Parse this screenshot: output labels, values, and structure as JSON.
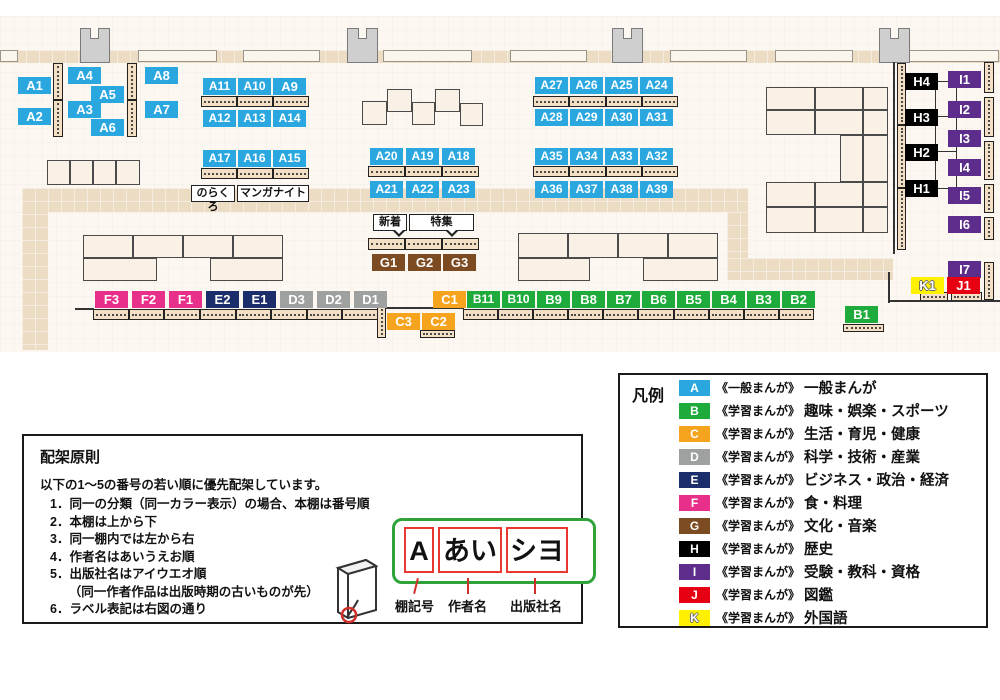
{
  "palette": {
    "A": "#2BA7E0",
    "B": "#1FAA3C",
    "C": "#F6A41D",
    "D": "#9FA0A0",
    "E": "#1C2D6C",
    "F": "#E8308A",
    "G": "#7C4B22",
    "H": "#000000",
    "I": "#5C2D8B",
    "J": "#E60012",
    "K": "#FFF100"
  },
  "map": {
    "wall_segments": [
      {
        "x": 0,
        "w": 18
      },
      {
        "x": 138,
        "w": 79
      },
      {
        "x": 243,
        "w": 77
      },
      {
        "x": 383,
        "w": 89
      },
      {
        "x": 510,
        "w": 77
      },
      {
        "x": 670,
        "w": 77
      },
      {
        "x": 775,
        "w": 78
      },
      {
        "x": 903,
        "w": 96
      }
    ],
    "pillars": [
      {
        "x": 80,
        "y": 28,
        "w": 30,
        "h": 35
      },
      {
        "x": 347,
        "y": 28,
        "w": 31,
        "h": 35
      },
      {
        "x": 612,
        "y": 28,
        "w": 31,
        "h": 35
      },
      {
        "x": 879,
        "y": 28,
        "w": 31,
        "h": 35
      }
    ],
    "paths": [
      {
        "x": 0,
        "y": 50,
        "w": 1000,
        "h": 13
      },
      {
        "x": 22,
        "y": 188,
        "w": 726,
        "h": 24
      },
      {
        "x": 22,
        "y": 188,
        "w": 26,
        "h": 162
      },
      {
        "x": 727,
        "y": 212,
        "w": 21,
        "h": 46
      },
      {
        "x": 727,
        "y": 258,
        "w": 166,
        "h": 22
      }
    ],
    "tables": [
      {
        "x": 47,
        "y": 160,
        "w": 23,
        "h": 25
      },
      {
        "x": 70,
        "y": 160,
        "w": 23,
        "h": 25
      },
      {
        "x": 93,
        "y": 160,
        "w": 23,
        "h": 25
      },
      {
        "x": 116,
        "y": 160,
        "w": 24,
        "h": 25
      },
      {
        "x": 387,
        "y": 89,
        "w": 25,
        "h": 23
      },
      {
        "x": 435,
        "y": 89,
        "w": 25,
        "h": 23
      },
      {
        "x": 362,
        "y": 101,
        "w": 25,
        "h": 24
      },
      {
        "x": 412,
        "y": 102,
        "w": 23,
        "h": 23
      },
      {
        "x": 460,
        "y": 103,
        "w": 23,
        "h": 23
      },
      {
        "x": 83,
        "y": 235,
        "w": 50,
        "h": 23
      },
      {
        "x": 133,
        "y": 235,
        "w": 50,
        "h": 23
      },
      {
        "x": 183,
        "y": 235,
        "w": 50,
        "h": 23
      },
      {
        "x": 233,
        "y": 235,
        "w": 50,
        "h": 23
      },
      {
        "x": 83,
        "y": 258,
        "w": 74,
        "h": 23
      },
      {
        "x": 210,
        "y": 258,
        "w": 73,
        "h": 23
      },
      {
        "x": 518,
        "y": 233,
        "w": 50,
        "h": 25
      },
      {
        "x": 568,
        "y": 233,
        "w": 50,
        "h": 25
      },
      {
        "x": 618,
        "y": 233,
        "w": 50,
        "h": 25
      },
      {
        "x": 668,
        "y": 233,
        "w": 50,
        "h": 25
      },
      {
        "x": 518,
        "y": 258,
        "w": 72,
        "h": 23
      },
      {
        "x": 643,
        "y": 258,
        "w": 75,
        "h": 23
      },
      {
        "x": 766,
        "y": 87,
        "w": 49,
        "h": 23
      },
      {
        "x": 815,
        "y": 87,
        "w": 48,
        "h": 23
      },
      {
        "x": 863,
        "y": 87,
        "w": 25,
        "h": 23
      },
      {
        "x": 766,
        "y": 110,
        "w": 49,
        "h": 25
      },
      {
        "x": 815,
        "y": 110,
        "w": 48,
        "h": 25
      },
      {
        "x": 863,
        "y": 110,
        "w": 25,
        "h": 25
      },
      {
        "x": 840,
        "y": 135,
        "w": 23,
        "h": 47
      },
      {
        "x": 863,
        "y": 135,
        "w": 25,
        "h": 47
      },
      {
        "x": 766,
        "y": 182,
        "w": 49,
        "h": 25
      },
      {
        "x": 815,
        "y": 182,
        "w": 48,
        "h": 25
      },
      {
        "x": 863,
        "y": 182,
        "w": 25,
        "h": 25
      },
      {
        "x": 766,
        "y": 207,
        "w": 49,
        "h": 26
      },
      {
        "x": 815,
        "y": 207,
        "w": 48,
        "h": 26
      },
      {
        "x": 863,
        "y": 207,
        "w": 25,
        "h": 26
      }
    ],
    "shelves_h": [
      {
        "x": 201,
        "y": 96,
        "w": 108,
        "h": 11,
        "n": 3
      },
      {
        "x": 201,
        "y": 168,
        "w": 108,
        "h": 11,
        "n": 3
      },
      {
        "x": 368,
        "y": 166,
        "w": 111,
        "h": 11,
        "n": 3
      },
      {
        "x": 533,
        "y": 96,
        "w": 145,
        "h": 11,
        "n": 4
      },
      {
        "x": 533,
        "y": 166,
        "w": 145,
        "h": 11,
        "n": 4
      },
      {
        "x": 368,
        "y": 238,
        "w": 111,
        "h": 12,
        "n": 3
      },
      {
        "x": 93,
        "y": 309,
        "w": 285,
        "h": 11,
        "n": 8
      },
      {
        "x": 463,
        "y": 309,
        "w": 351,
        "h": 11,
        "n": 10
      },
      {
        "x": 420,
        "y": 330,
        "w": 35,
        "h": 8,
        "n": 1
      },
      {
        "x": 843,
        "y": 324,
        "w": 41,
        "h": 8,
        "n": 1
      },
      {
        "x": 920,
        "y": 292,
        "w": 28,
        "h": 9,
        "n": 1
      },
      {
        "x": 951,
        "y": 292,
        "w": 31,
        "h": 9,
        "n": 1
      }
    ],
    "shelves_v": [
      {
        "x": 53,
        "y": 63,
        "w": 10,
        "h": 74,
        "n": 2
      },
      {
        "x": 127,
        "y": 63,
        "w": 10,
        "h": 74,
        "n": 2
      },
      {
        "x": 377,
        "y": 306,
        "w": 9,
        "h": 32,
        "n": 1
      },
      {
        "x": 897,
        "y": 63,
        "w": 9,
        "h": 187,
        "n": 3
      },
      {
        "x": 984,
        "y": 62,
        "w": 10,
        "h": 31,
        "n": 1
      },
      {
        "x": 984,
        "y": 97,
        "w": 10,
        "h": 40,
        "n": 1
      },
      {
        "x": 984,
        "y": 141,
        "w": 10,
        "h": 39,
        "n": 1
      },
      {
        "x": 984,
        "y": 184,
        "w": 10,
        "h": 29,
        "n": 1
      },
      {
        "x": 984,
        "y": 217,
        "w": 10,
        "h": 23,
        "n": 1
      },
      {
        "x": 984,
        "y": 262,
        "w": 10,
        "h": 38,
        "n": 1
      }
    ],
    "lines": [
      {
        "x": 893,
        "y": 62,
        "w": 2,
        "h": 192
      },
      {
        "x": 888,
        "y": 272,
        "w": 2,
        "h": 31
      },
      {
        "x": 889,
        "y": 300,
        "w": 111,
        "h": 2
      },
      {
        "x": 75,
        "y": 308,
        "w": 19,
        "h": 2
      },
      {
        "x": 386,
        "y": 307,
        "w": 78,
        "h": 2
      },
      {
        "x": 935,
        "y": 81,
        "w": 1,
        "h": 108
      },
      {
        "x": 956,
        "y": 81,
        "w": 1,
        "h": 108
      },
      {
        "x": 936,
        "y": 81,
        "w": 21,
        "h": 1
      },
      {
        "x": 936,
        "y": 116,
        "w": 21,
        "h": 1
      },
      {
        "x": 936,
        "y": 151,
        "w": 21,
        "h": 1
      },
      {
        "x": 936,
        "y": 188,
        "w": 21,
        "h": 1
      }
    ],
    "labels": [
      {
        "t": "A1",
        "x": 18,
        "y": 77
      },
      {
        "t": "A2",
        "x": 18,
        "y": 108
      },
      {
        "t": "A4",
        "x": 68,
        "y": 67
      },
      {
        "t": "A5",
        "x": 91,
        "y": 86
      },
      {
        "t": "A3",
        "x": 68,
        "y": 101
      },
      {
        "t": "A6",
        "x": 91,
        "y": 119
      },
      {
        "t": "A8",
        "x": 145,
        "y": 67
      },
      {
        "t": "A7",
        "x": 145,
        "y": 101
      },
      {
        "t": "A11",
        "x": 203,
        "y": 78
      },
      {
        "t": "A10",
        "x": 238,
        "y": 78
      },
      {
        "t": "A9",
        "x": 273,
        "y": 78
      },
      {
        "t": "A12",
        "x": 203,
        "y": 110
      },
      {
        "t": "A13",
        "x": 238,
        "y": 110
      },
      {
        "t": "A14",
        "x": 273,
        "y": 110
      },
      {
        "t": "A17",
        "x": 203,
        "y": 150
      },
      {
        "t": "A16",
        "x": 238,
        "y": 150
      },
      {
        "t": "A15",
        "x": 273,
        "y": 150
      },
      {
        "t": "A20",
        "x": 370,
        "y": 148
      },
      {
        "t": "A19",
        "x": 406,
        "y": 148
      },
      {
        "t": "A18",
        "x": 442,
        "y": 148
      },
      {
        "t": "A21",
        "x": 370,
        "y": 181
      },
      {
        "t": "A22",
        "x": 406,
        "y": 181
      },
      {
        "t": "A23",
        "x": 442,
        "y": 181
      },
      {
        "t": "A27",
        "x": 535,
        "y": 77
      },
      {
        "t": "A26",
        "x": 570,
        "y": 77
      },
      {
        "t": "A25",
        "x": 605,
        "y": 77
      },
      {
        "t": "A24",
        "x": 640,
        "y": 77
      },
      {
        "t": "A28",
        "x": 535,
        "y": 109
      },
      {
        "t": "A29",
        "x": 570,
        "y": 109
      },
      {
        "t": "A30",
        "x": 605,
        "y": 109
      },
      {
        "t": "A31",
        "x": 640,
        "y": 109
      },
      {
        "t": "A35",
        "x": 535,
        "y": 148
      },
      {
        "t": "A34",
        "x": 570,
        "y": 148
      },
      {
        "t": "A33",
        "x": 605,
        "y": 148
      },
      {
        "t": "A32",
        "x": 640,
        "y": 148
      },
      {
        "t": "A36",
        "x": 535,
        "y": 181
      },
      {
        "t": "A37",
        "x": 570,
        "y": 181
      },
      {
        "t": "A38",
        "x": 605,
        "y": 181
      },
      {
        "t": "A39",
        "x": 640,
        "y": 181
      },
      {
        "t": "G1",
        "x": 372,
        "y": 254
      },
      {
        "t": "G2",
        "x": 408,
        "y": 254
      },
      {
        "t": "G3",
        "x": 443,
        "y": 254
      },
      {
        "t": "F3",
        "x": 95,
        "y": 291
      },
      {
        "t": "F2",
        "x": 132,
        "y": 291
      },
      {
        "t": "F1",
        "x": 169,
        "y": 291
      },
      {
        "t": "E2",
        "x": 206,
        "y": 291
      },
      {
        "t": "E1",
        "x": 243,
        "y": 291
      },
      {
        "t": "D3",
        "x": 280,
        "y": 291
      },
      {
        "t": "D2",
        "x": 317,
        "y": 291
      },
      {
        "t": "D1",
        "x": 354,
        "y": 291
      },
      {
        "t": "C1",
        "x": 433,
        "y": 291
      },
      {
        "t": "B11",
        "x": 467,
        "y": 291
      },
      {
        "t": "B10",
        "x": 502,
        "y": 291
      },
      {
        "t": "B9",
        "x": 537,
        "y": 291
      },
      {
        "t": "B8",
        "x": 572,
        "y": 291
      },
      {
        "t": "B7",
        "x": 607,
        "y": 291
      },
      {
        "t": "B6",
        "x": 642,
        "y": 291
      },
      {
        "t": "B5",
        "x": 677,
        "y": 291
      },
      {
        "t": "B4",
        "x": 712,
        "y": 291
      },
      {
        "t": "B3",
        "x": 747,
        "y": 291
      },
      {
        "t": "B2",
        "x": 782,
        "y": 291
      },
      {
        "t": "C3",
        "x": 387,
        "y": 313
      },
      {
        "t": "C2",
        "x": 422,
        "y": 313
      },
      {
        "t": "B1",
        "x": 845,
        "y": 306
      },
      {
        "t": "H4",
        "x": 905,
        "y": 73
      },
      {
        "t": "H3",
        "x": 905,
        "y": 109
      },
      {
        "t": "H2",
        "x": 905,
        "y": 144
      },
      {
        "t": "H1",
        "x": 905,
        "y": 180
      },
      {
        "t": "I1",
        "x": 948,
        "y": 71
      },
      {
        "t": "I2",
        "x": 948,
        "y": 101
      },
      {
        "t": "I3",
        "x": 948,
        "y": 130
      },
      {
        "t": "I4",
        "x": 948,
        "y": 159
      },
      {
        "t": "I5",
        "x": 948,
        "y": 187
      },
      {
        "t": "I6",
        "x": 948,
        "y": 216
      },
      {
        "t": "I7",
        "x": 948,
        "y": 261
      },
      {
        "t": "K1",
        "x": 911,
        "y": 277
      },
      {
        "t": "J1",
        "x": 947,
        "y": 277
      }
    ],
    "tags": [
      {
        "t": "のらくろ",
        "x": 191,
        "y": 185,
        "w": 44,
        "bubble": false
      },
      {
        "t": "マンガナイト",
        "x": 237,
        "y": 185,
        "w": 72,
        "bubble": false
      },
      {
        "t": "新着",
        "x": 373,
        "y": 214,
        "w": 34,
        "bubble": true
      },
      {
        "t": "特集",
        "x": 409,
        "y": 214,
        "w": 65,
        "bubble": true
      }
    ]
  },
  "principles": {
    "title": "配架原則",
    "intro": "以下の1～5の番号の若い順に優先配架しています。",
    "items": [
      "1．同一の分類（同一カラー表示）の場合、本棚は番号順",
      "2．本棚は上から下",
      "3．同一棚内では左から右",
      "4．作者名はあいうえお順",
      "5．出版社名はアイウエオ順",
      "　　（同一作者作品は出版時期の古いものが先）",
      "6．ラベル表記は右図の通り"
    ]
  },
  "diagram": {
    "plate_fields": [
      {
        "value": "A",
        "caption": "棚記号"
      },
      {
        "value": "あい",
        "caption": "作者名"
      },
      {
        "value": "シヨ",
        "caption": "出版社名"
      }
    ]
  },
  "legend": {
    "title": "凡例",
    "rows": [
      {
        "key": "A",
        "tag": "《一般まんが》",
        "label": "一般まんが"
      },
      {
        "key": "B",
        "tag": "《学習まんが》",
        "label": "趣味・娯楽・スポーツ"
      },
      {
        "key": "C",
        "tag": "《学習まんが》",
        "label": "生活・育児・健康"
      },
      {
        "key": "D",
        "tag": "《学習まんが》",
        "label": "科学・技術・産業"
      },
      {
        "key": "E",
        "tag": "《学習まんが》",
        "label": "ビジネス・政治・経済"
      },
      {
        "key": "F",
        "tag": "《学習まんが》",
        "label": "食・料理"
      },
      {
        "key": "G",
        "tag": "《学習まんが》",
        "label": "文化・音楽"
      },
      {
        "key": "H",
        "tag": "《学習まんが》",
        "label": "歴史"
      },
      {
        "key": "I",
        "tag": "《学習まんが》",
        "label": "受験・教科・資格"
      },
      {
        "key": "J",
        "tag": "《学習まんが》",
        "label": "図鑑"
      },
      {
        "key": "K",
        "tag": "《学習まんが》",
        "label": "外国語"
      }
    ]
  }
}
